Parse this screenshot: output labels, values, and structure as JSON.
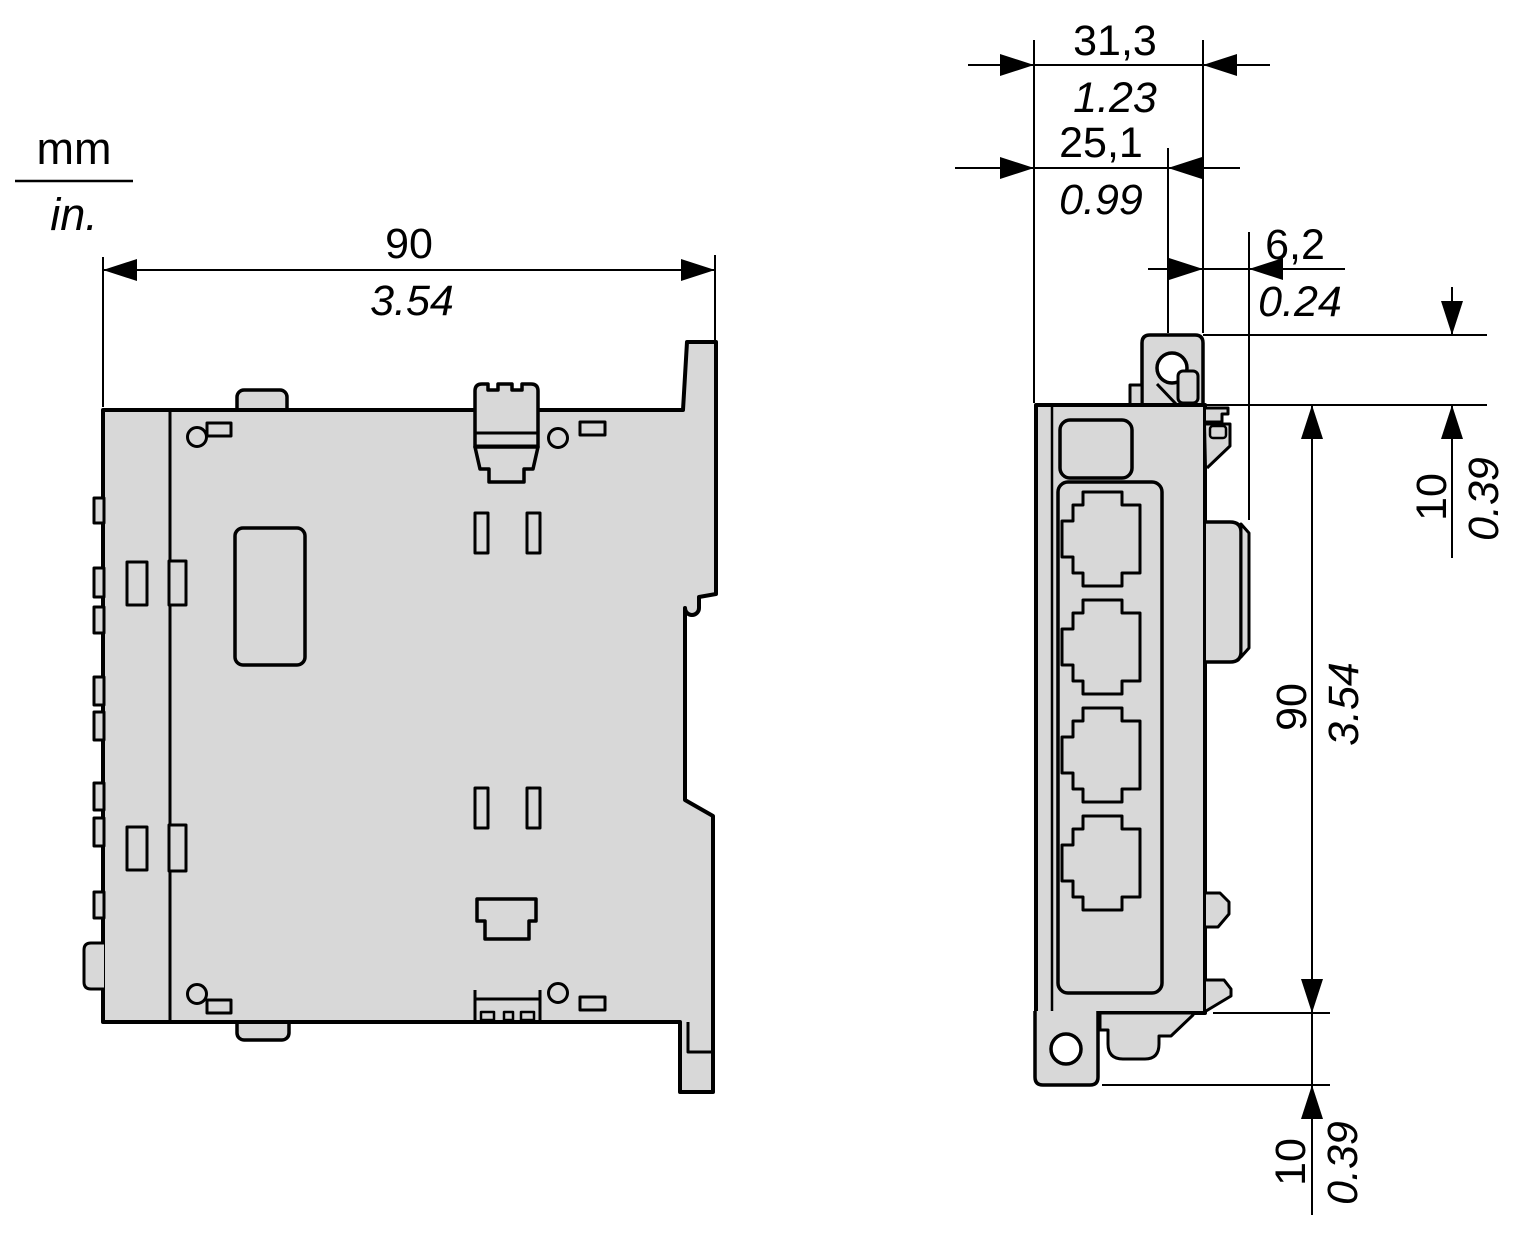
{
  "legend": {
    "unit_top": "mm",
    "unit_bottom": "in."
  },
  "side_view": {
    "width": {
      "mm": "90",
      "inch": "3.54"
    }
  },
  "front_view": {
    "overall_width": {
      "mm": "31,3",
      "inch": "1.23"
    },
    "mount_hole_offset": {
      "mm": "25,1",
      "inch": "0.99"
    },
    "din_rail_offset": {
      "mm": "6,2",
      "inch": "0.24"
    },
    "top_tab_height": {
      "mm": "10",
      "inch": "0.39"
    },
    "body_height": {
      "mm": "90",
      "inch": "3.54"
    },
    "bottom_tab_height": {
      "mm": "10",
      "inch": "0.39"
    }
  },
  "colors": {
    "body_fill": "#d8d8d8",
    "outline": "#000000",
    "background": "#ffffff"
  }
}
